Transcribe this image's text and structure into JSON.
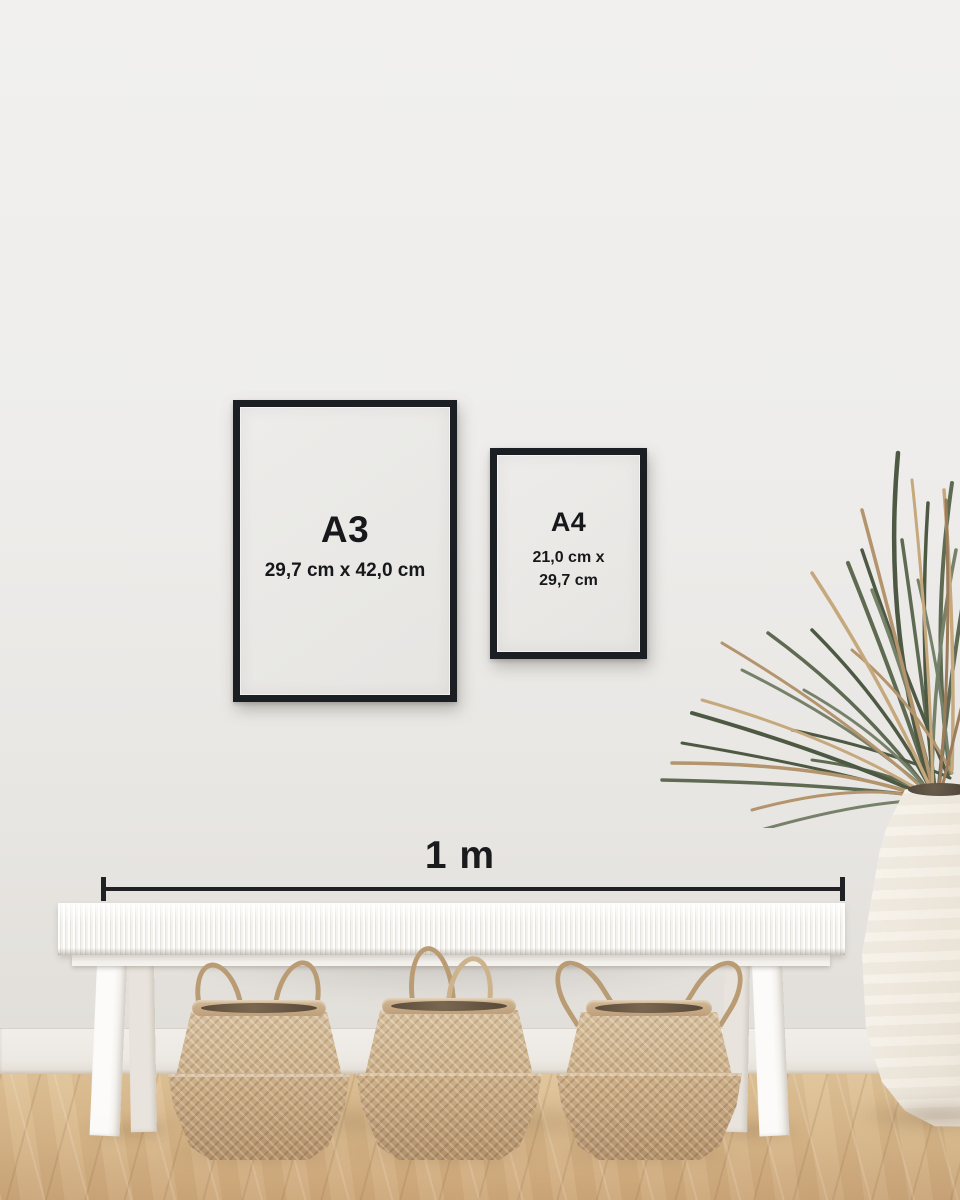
{
  "size_guide": {
    "frames": [
      {
        "label": "A3",
        "dimensions": [
          "29,7 cm x 42,0 cm"
        ]
      },
      {
        "label": "A4",
        "dimensions": [
          "21,0 cm x",
          "29,7 cm"
        ]
      }
    ],
    "scale": {
      "label": "1 m"
    }
  },
  "colors": {
    "text": "#17181b",
    "frame": "#1b1e22",
    "paper": "#e9e8e6",
    "wall": "#eeedeb",
    "baseboard": "#efece8",
    "floor_light": "#e0c59c",
    "floor_dark": "#cda87c",
    "bench": "#f8f6f3",
    "basket": "#c7ab85",
    "plant_green": "#5e6a52",
    "plant_tan": "#b3946c",
    "vase": "#efe8dc"
  }
}
